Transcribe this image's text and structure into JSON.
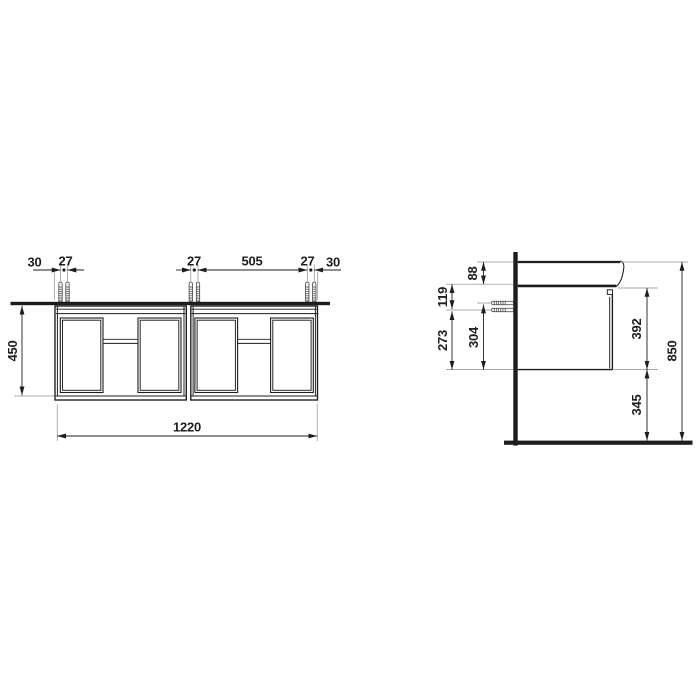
{
  "front_view": {
    "dim_30_left": "30",
    "dim_27_left": "27",
    "dim_27_mid": "27",
    "dim_505": "505",
    "dim_27_right": "27",
    "dim_30_right": "30",
    "dim_height_450": "450",
    "dim_width_1220": "1220"
  },
  "side_view": {
    "dim_88": "88",
    "dim_119": "119",
    "dim_273": "273",
    "dim_304": "304",
    "dim_392": "392",
    "dim_345": "345",
    "dim_850": "850"
  },
  "colors": {
    "line": "#1d1d1b",
    "extension_line": "#8c8c8c",
    "background": "#ffffff"
  }
}
